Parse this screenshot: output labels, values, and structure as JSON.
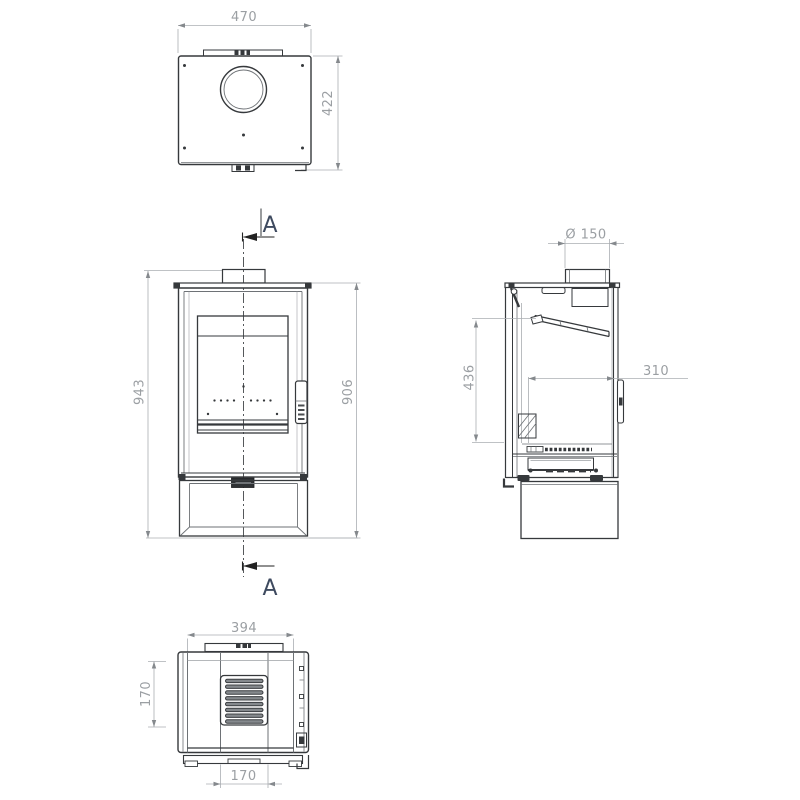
{
  "drawing": {
    "section_label": "A",
    "views": {
      "top": {
        "width": "470",
        "depth": "422"
      },
      "front": {
        "overall_height": "943",
        "body_height": "906"
      },
      "side": {
        "flue_diameter": "Ø 150",
        "firebox_height": "436",
        "firebox_depth": "310"
      },
      "bottom": {
        "top_width": "394",
        "vent_height": "170",
        "vent_width": "170"
      }
    },
    "colors": {
      "line_dark": "#36393c",
      "line_mid": "#6e7276",
      "dimension": "#abafb3",
      "dimension_text": "#9b9fa3",
      "section_text": "#3e4a5f",
      "badge": "#2e3134",
      "background": "#ffffff"
    }
  }
}
